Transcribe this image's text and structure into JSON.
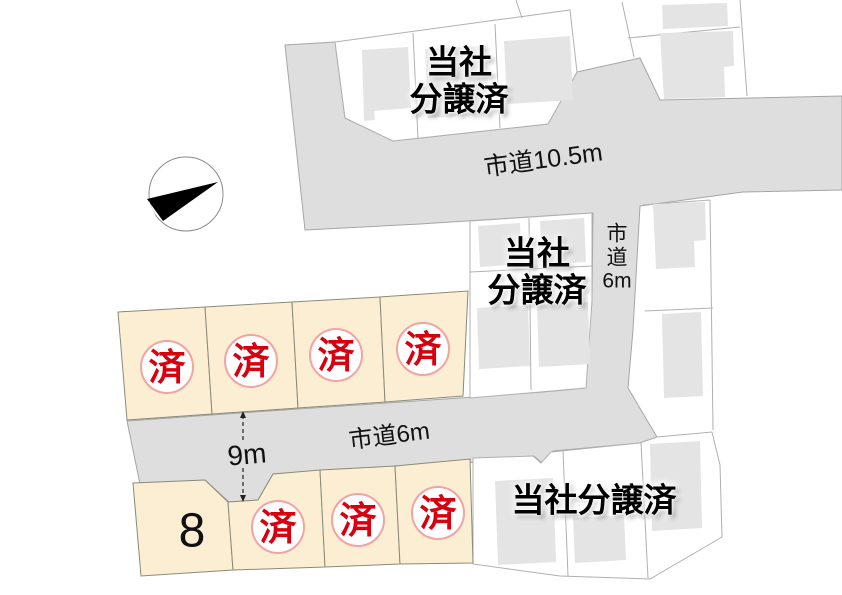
{
  "compass": {
    "icon": "north-arrow"
  },
  "roads": {
    "main_label": "市道10.5m",
    "vertical_label_lines": [
      "市",
      "道",
      "6m"
    ],
    "lower_label": "市道6m",
    "width_note": "9m"
  },
  "sold_area_labels": {
    "top": [
      "当社",
      "分譲済"
    ],
    "middle": [
      "当社",
      "分譲済"
    ],
    "bottom_right": "当社分譲済"
  },
  "lots": {
    "sold_mark": "済",
    "available_number": "8",
    "top_row_sold_count": 4,
    "bottom_row_sold_count": 3
  },
  "colors": {
    "road": "#dedede",
    "lot_sold_fill": "#fbeed3",
    "building": "#e4e4e4",
    "white_lot": "#ffffff",
    "badge_border": "#f2a3a3",
    "badge_text": "#d7000f",
    "label_text": "#000000"
  }
}
